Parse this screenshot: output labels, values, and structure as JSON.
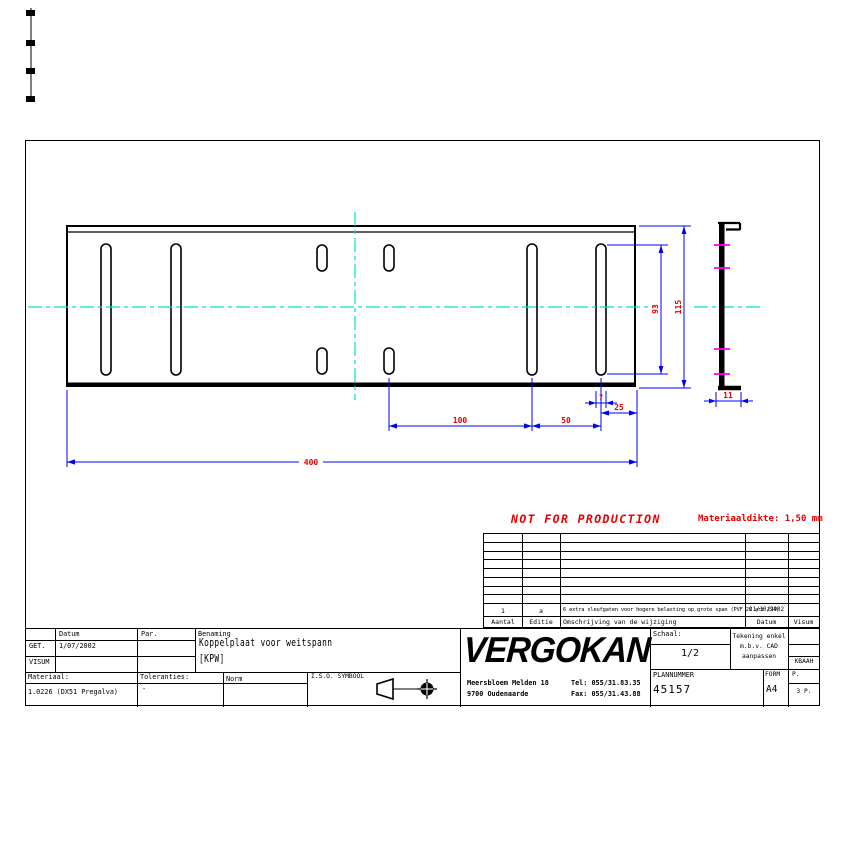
{
  "drawing": {
    "dims": {
      "d400": "400",
      "d100": "100",
      "d50": "50",
      "d25": "25",
      "d7": "7",
      "d93": "93",
      "d115": "115",
      "d11": "11"
    }
  },
  "notes": {
    "not_for_production": "NOT FOR PRODUCTION",
    "material_thickness": "Materiaaldikte: 1,50 mm"
  },
  "revision_table": {
    "headers": [
      "Aantal",
      "Editie",
      "Omschrijving van de wijziging",
      "Datum",
      "Visum"
    ],
    "rows": [
      {
        "aantal": "1",
        "editie": "a",
        "omschrijving": "6 extra sleufgaten voor hogere belasting op grote span (PVF 26 art 294)",
        "datum": "21/10/2002",
        "visum": ""
      }
    ]
  },
  "title_block": {
    "labels": {
      "datum": "Datum",
      "par": "Par.",
      "benaming": "Benaming",
      "get": "GET.",
      "visum": "VISUM",
      "materiaal": "Materiaal:",
      "toleranties": "Toleranties:",
      "norm": "Norm",
      "iso_symbool": "I.S.O. SYMBOOL",
      "schaal": "Schaal:",
      "plannummer": "PLANNUMMER",
      "form": "FORM",
      "p": "P."
    },
    "values": {
      "get_datum": "1/07/2002",
      "benaming_line1": "Koppelplaat voor weitspann",
      "benaming_line2": "[KPW]",
      "materiaal": "1.0226 (DX51 Pregalva)",
      "toleranties": "-",
      "schaal": "1/2",
      "plannummer": "45157",
      "form": "A4",
      "pages": "3 P.",
      "visum_code": "KBAAH"
    },
    "cad_note": {
      "line1": "Tekening enkel",
      "line2": "m.b.v. CAD",
      "line3": "aanpassen"
    },
    "company": {
      "name": "VERGOKAN",
      "address1": "Meersbloem Melden 18",
      "address2": "9700 Oudenaarde",
      "tel": "Tel: 055/31.83.35",
      "fax": "Fax: 055/31.43.88"
    }
  },
  "colors": {
    "dimension_line": "#0000f0",
    "dimension_text": "#e60000",
    "centerline": "#00dede",
    "note_red": "#e80000",
    "slot_mark": "#ff00ff"
  }
}
